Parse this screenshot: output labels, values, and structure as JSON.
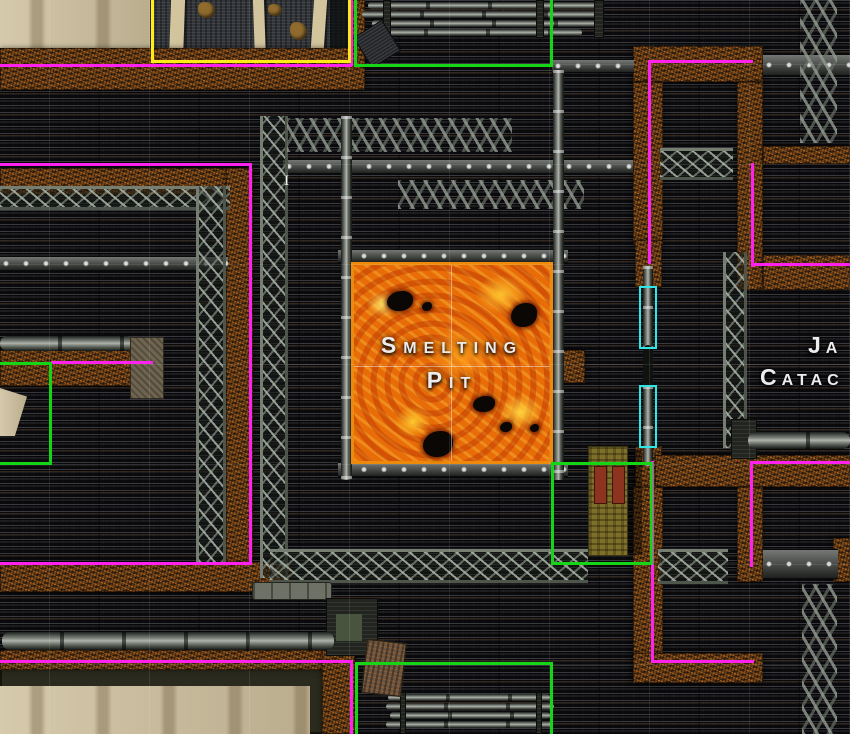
{
  "map": {
    "labels": {
      "smelting_pit": {
        "line1": "Smelting",
        "line2": "Pit"
      },
      "right_room": {
        "line1": "Ja",
        "line2": "Catac"
      },
      "cursor_mark": "I"
    }
  },
  "colors": {
    "region_magenta": "#ff22ee",
    "region_green": "#16d416",
    "region_yellow": "#ffec16",
    "door_cyan": "#2ee6e6",
    "lava_border": "#ed8a0c",
    "lava_hot": "#ff9e1a",
    "rust_wall": "#6e4118",
    "floor_dark": "#17171a",
    "sand": "#cfc19e"
  }
}
